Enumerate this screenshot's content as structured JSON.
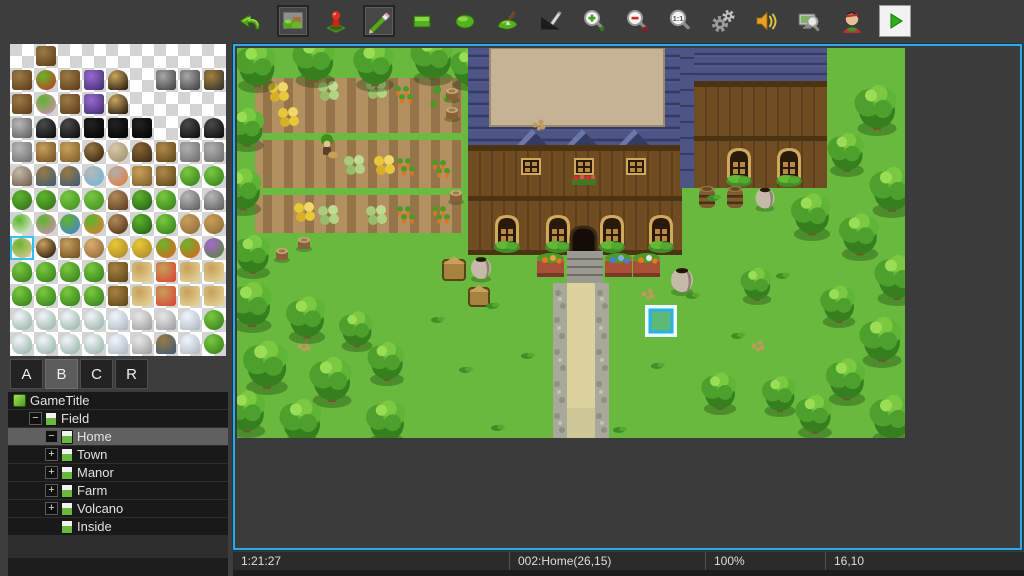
{
  "toolbar": {
    "zoom_actual_label": "1:1",
    "buttons": [
      {
        "name": "undo",
        "pressed": false
      },
      {
        "name": "map-mode",
        "pressed": true
      },
      {
        "name": "event-mode",
        "pressed": false
      },
      {
        "name": "pencil-tool",
        "pressed": true
      },
      {
        "name": "rectangle-tool",
        "pressed": false
      },
      {
        "name": "ellipse-tool",
        "pressed": false
      },
      {
        "name": "flood-fill-tool",
        "pressed": false
      },
      {
        "name": "shadow-pen-tool",
        "pressed": false
      },
      {
        "name": "zoom-in",
        "pressed": false
      },
      {
        "name": "zoom-out",
        "pressed": false
      },
      {
        "name": "zoom-actual",
        "pressed": false
      },
      {
        "name": "database",
        "pressed": false
      },
      {
        "name": "sound-test",
        "pressed": false
      },
      {
        "name": "find",
        "pressed": false
      },
      {
        "name": "character-generator",
        "pressed": false
      },
      {
        "name": "playtest",
        "pressed": false
      }
    ]
  },
  "palette": {
    "tabs": [
      {
        "label": "A",
        "selected": false
      },
      {
        "label": "B",
        "selected": true
      },
      {
        "label": "C",
        "selected": false
      },
      {
        "label": "R",
        "selected": false
      }
    ],
    "selected_cell": {
      "row": 8,
      "col": 0
    },
    "tile_types": {
      "door": [
        "#9a7a45",
        "#5a3a18",
        "r"
      ],
      "bushred": [
        "#6ab52c",
        "#c03020",
        "c"
      ],
      "glass": [
        "#9a6ad0",
        "#3a2a6a",
        "r"
      ],
      "arch": [
        "#caa45c",
        "#1a120a",
        "d"
      ],
      "win": [
        "#a8a8a8",
        "#3a3a3a",
        "r"
      ],
      "awning": [
        "#a5823f",
        "#2a2a2a",
        "r"
      ],
      "pipes": [
        "#b8b8b8",
        "#5a5a5a",
        "r"
      ],
      "cap": [
        "#4a4a4a",
        "#0a0a0a",
        "d"
      ],
      "black": [
        "#222222",
        "#000000",
        "r"
      ],
      "well": [
        "#b8b8b8",
        "#6a6a6a",
        "r"
      ],
      "sign": [
        "#c8a05a",
        "#6a4a20",
        "r"
      ],
      "gate": [
        "#c8a05a",
        "#7a5a28",
        "r"
      ],
      "basin": [
        "#9a7a45",
        "#2a1a0a",
        "c"
      ],
      "plates": [
        "#d8c8a8",
        "#9a8a6a",
        "c"
      ],
      "barrel": [
        "#8a6535",
        "#3a2a12",
        "d"
      ],
      "totem": [
        "#b08a4a",
        "#5a4218",
        "r"
      ],
      "shrine": [
        "#b0b0b0",
        "#6a6a6a",
        "r"
      ],
      "jarg": [
        "#c5b9a8",
        "#6a5a4a",
        "d"
      ],
      "bucket": [
        "#9a7a45",
        "#3a5a7a",
        "d"
      ],
      "spring": [
        "#b8b8b8",
        "#6ab5d8",
        "c"
      ],
      "fire": [
        "#b0b0b0",
        "#e87830",
        "c"
      ],
      "sprout": [
        "#7ac940",
        "#2e7a18",
        "c"
      ],
      "tuft": [
        "#5cb52e",
        "#2e6a18",
        "c"
      ],
      "leaves": [
        "#7ac940",
        "#3a8a20",
        "c"
      ],
      "stump": [
        "#b08a5a",
        "#5a3a1a",
        "d"
      ],
      "conetree": [
        "#5cb52e",
        "#1e5a10",
        "t"
      ],
      "roundtree": [
        "#7ac940",
        "#2e7a18",
        "t"
      ],
      "rock": [
        "#b8b8b8",
        "#5a5a5a",
        "d"
      ],
      "flw": [
        "#5cb52e",
        "#f0f0f0",
        "c"
      ],
      "flp": [
        "#5cb52e",
        "#e088c0",
        "c"
      ],
      "flb": [
        "#5cb52e",
        "#4a7ae0",
        "c"
      ],
      "flo": [
        "#5cb52e",
        "#e87830",
        "c"
      ],
      "log": [
        "#b08a5a",
        "#4a2a10",
        "c"
      ],
      "dirt": [
        "#c8a05a",
        "#8a6535",
        "c"
      ],
      "doll": [
        "#6ab52c",
        "#e8c8a0",
        "c"
      ],
      "nest": [
        "#c8a05a",
        "#140a02",
        "c"
      ],
      "wood": [
        "#c8a05a",
        "#6a4a20",
        "r"
      ],
      "acorn": [
        "#d8b070",
        "#8a6030",
        "c"
      ],
      "cropy": [
        "#e8c838",
        "#a5822a",
        "c"
      ],
      "sapl": [
        "#6ab52c",
        "#e85a20",
        "c"
      ],
      "grape": [
        "#a868d0",
        "#4a8a2a",
        "c"
      ],
      "bigtree": [
        "#7ac940",
        "#2e7a18",
        "t"
      ],
      "plank": [
        "#a5823f",
        "#5a4218",
        "r"
      ],
      "crate": [
        "#c8a05a",
        "#e8d8a0",
        "r"
      ],
      "crater": [
        "#c8a05a",
        "#d84030",
        "r"
      ],
      "snowtree": [
        "#f0f5fa",
        "#8fae9f",
        "t"
      ],
      "snow": [
        "#f0f5fa",
        "#aab5c0",
        "d"
      ],
      "wjar": [
        "#e8e8e8",
        "#9a9a9a",
        "d"
      ]
    },
    "grid": [
      [
        "",
        "door",
        "",
        "",
        "",
        "",
        "",
        "",
        ""
      ],
      [
        "door",
        "bushred",
        "door",
        "glass",
        "arch",
        "",
        "win",
        "win",
        "awning"
      ],
      [
        "door",
        "flp",
        "door",
        "glass",
        "arch",
        "",
        "",
        "",
        ""
      ],
      [
        "pipes",
        "cap",
        "cap",
        "black",
        "black",
        "black",
        "",
        "cap",
        "cap"
      ],
      [
        "well",
        "sign",
        "gate",
        "basin",
        "plates",
        "barrel",
        "totem",
        "shrine",
        "shrine"
      ],
      [
        "jarg",
        "bucket",
        "bucket",
        "spring",
        "fire",
        "gate",
        "totem",
        "sprout",
        "sprout"
      ],
      [
        "tuft",
        "tuft",
        "leaves",
        "leaves",
        "stump",
        "conetree",
        "roundtree",
        "rock",
        "rock"
      ],
      [
        "flw",
        "flp",
        "flb",
        "flo",
        "log",
        "conetree",
        "roundtree",
        "dirt",
        "dirt"
      ],
      [
        "doll",
        "nest",
        "wood",
        "acorn",
        "cropy",
        "cropy",
        "sapl",
        "sapl",
        "grape"
      ],
      [
        "bigtree",
        "bigtree",
        "bigtree",
        "bigtree",
        "plank",
        "crate",
        "crater",
        "crate",
        "crate"
      ],
      [
        "bigtree",
        "bigtree",
        "bigtree",
        "bigtree",
        "plank",
        "crate",
        "crater",
        "crate",
        "crate"
      ],
      [
        "snowtree",
        "snowtree",
        "snowtree",
        "snowtree",
        "snow",
        "wjar",
        "wjar",
        "snow",
        "sprout"
      ],
      [
        "snowtree",
        "snowtree",
        "snowtree",
        "snowtree",
        "snow",
        "wjar",
        "bucket",
        "snow",
        "sprout"
      ]
    ]
  },
  "map_tree": {
    "items": [
      {
        "label": "GameTitle",
        "indent": 0,
        "expander": "",
        "icon": "project",
        "selected": false
      },
      {
        "label": "Field",
        "indent": 1,
        "expander": "-",
        "icon": "map",
        "selected": false
      },
      {
        "label": "Home",
        "indent": 2,
        "expander": "-",
        "icon": "map",
        "selected": true
      },
      {
        "label": "Town",
        "indent": 2,
        "expander": "+",
        "icon": "map",
        "selected": false
      },
      {
        "label": "Manor",
        "indent": 2,
        "expander": "+",
        "icon": "map",
        "selected": false
      },
      {
        "label": "Farm",
        "indent": 2,
        "expander": "+",
        "icon": "map",
        "selected": false
      },
      {
        "label": "Volcano",
        "indent": 2,
        "expander": "+",
        "icon": "map",
        "selected": false
      },
      {
        "label": "Inside",
        "indent": 3,
        "expander": "",
        "icon": "map",
        "selected": false
      }
    ]
  },
  "statusbar": {
    "time": "1:21:27",
    "map_info": "002:Home(26,15)",
    "zoom": "100%",
    "coords": "16,10"
  },
  "canvas": {
    "border_color": "#2fa8e4",
    "cursor_tile": "16,10"
  }
}
